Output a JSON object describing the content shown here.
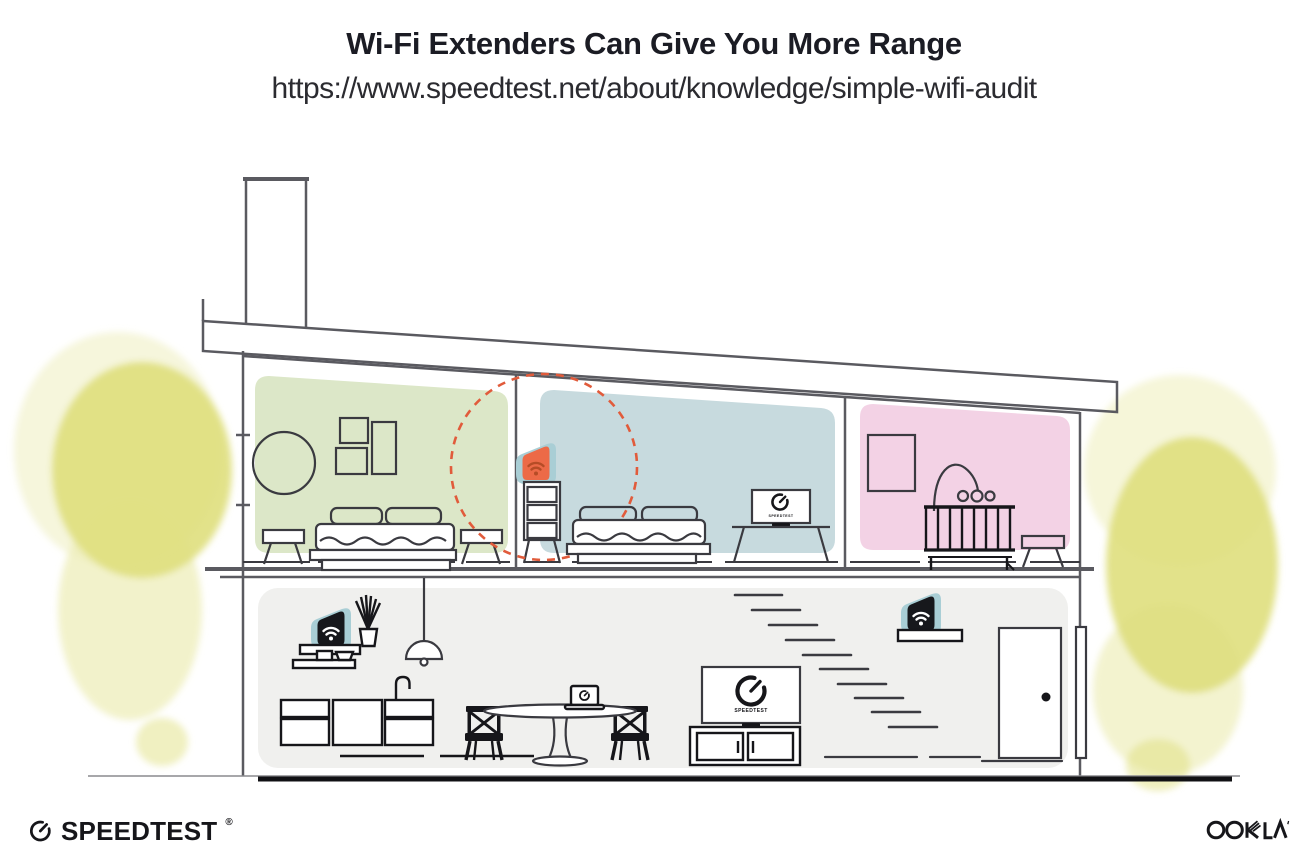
{
  "header": {
    "title": "Wi-Fi Extenders Can Give You More Range",
    "url": "https://www.speedtest.net/about/knowledge/simple-wifi-audit"
  },
  "illustration": {
    "tv_bedroom_label": "SPEEDTEST",
    "tv_living_label": "SPEEDTEST"
  },
  "footer": {
    "speedtest_wordmark": "SPEEDTEST",
    "speedtest_trademark": "®",
    "ookla_wordmark": "OOKLA"
  },
  "colors": {
    "title_text": "#1b1c24",
    "url_text": "#2b2b30",
    "green_room": "#dce7c8",
    "blue_room": "#c7dade",
    "pink_room": "#f3d2e5",
    "ground_floor": "#f0f0ee",
    "foliage": "#dfdf7d",
    "foliage_light": "#eeeeba",
    "extender_orange": "#ec6a47",
    "extender_orange_dark": "#b64c26",
    "extender_teal": "#a9ced5",
    "device_black": "#17181c",
    "signal_dashed": "#e15b3b",
    "structure_line": "#5a5a60",
    "furniture_line": "#3a3a40",
    "ink": "#16161a"
  }
}
